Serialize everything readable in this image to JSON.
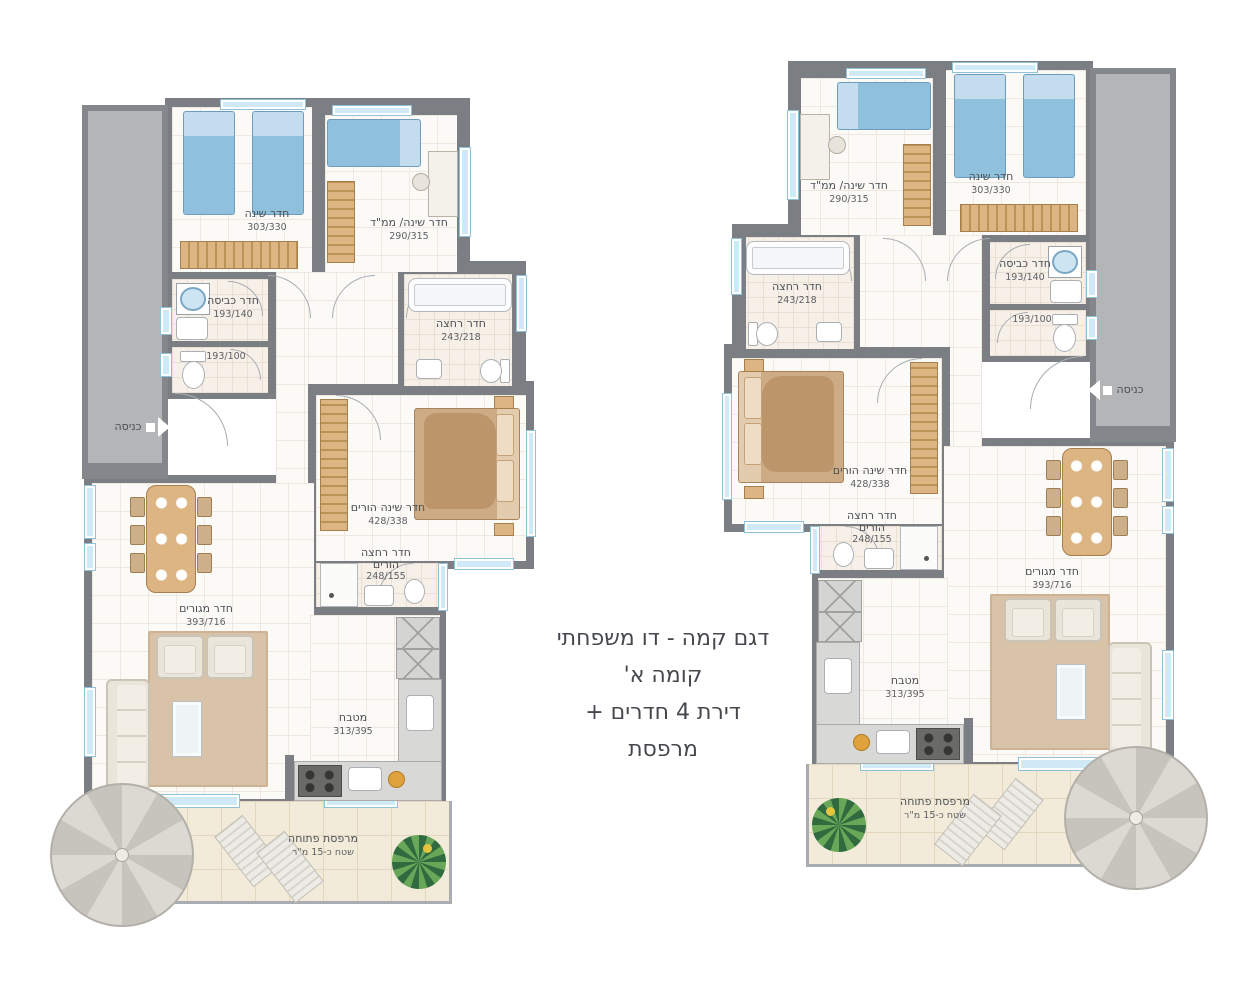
{
  "title_block": {
    "line1": "דגם קמה - דו משפחתי",
    "line2": "קומה א'",
    "line3": "דירת 4 חדרים + מרפסת"
  },
  "entrance": {
    "label": "כניסה"
  },
  "rooms": {
    "bedroom": {
      "name": "חדר שינה",
      "dims": "303/330"
    },
    "bedroom_mamad": {
      "name": "חדר שינה/ ממ\"ד",
      "dims": "290/315"
    },
    "laundry": {
      "name": "חדר כביסה",
      "dims": "193/140"
    },
    "toilet": {
      "dims": "193/100"
    },
    "bathroom": {
      "name": "חדר רחצה",
      "dims": "243/218"
    },
    "parents_bedroom": {
      "name": "חדר שינה הורים",
      "dims": "428/338"
    },
    "parents_bathroom": {
      "name_line1": "חדר רחצה",
      "name_line2": "הורים",
      "dims": "248/155"
    },
    "living_room": {
      "name": "חדר מגורים",
      "dims": "393/716"
    },
    "kitchen": {
      "name": "מטבח",
      "dims": "313/395"
    },
    "balcony": {
      "name": "מרפסת פתוחה",
      "area": "שטח כ-15 מ\"ר"
    }
  },
  "colors": {
    "wall": "#7b7e82",
    "common_fill": "#b4b5b7",
    "floor": "#fcfaf7",
    "balcony_floor": "#f3ebda",
    "window_blue": "#cfeaf6",
    "bed_blue": "#8fc0dc",
    "wood": "#dcb583",
    "parents_bed": "#cdab85",
    "sofa": "#eae5da",
    "rug": "#d9c3a8",
    "text": "#4b5055"
  }
}
